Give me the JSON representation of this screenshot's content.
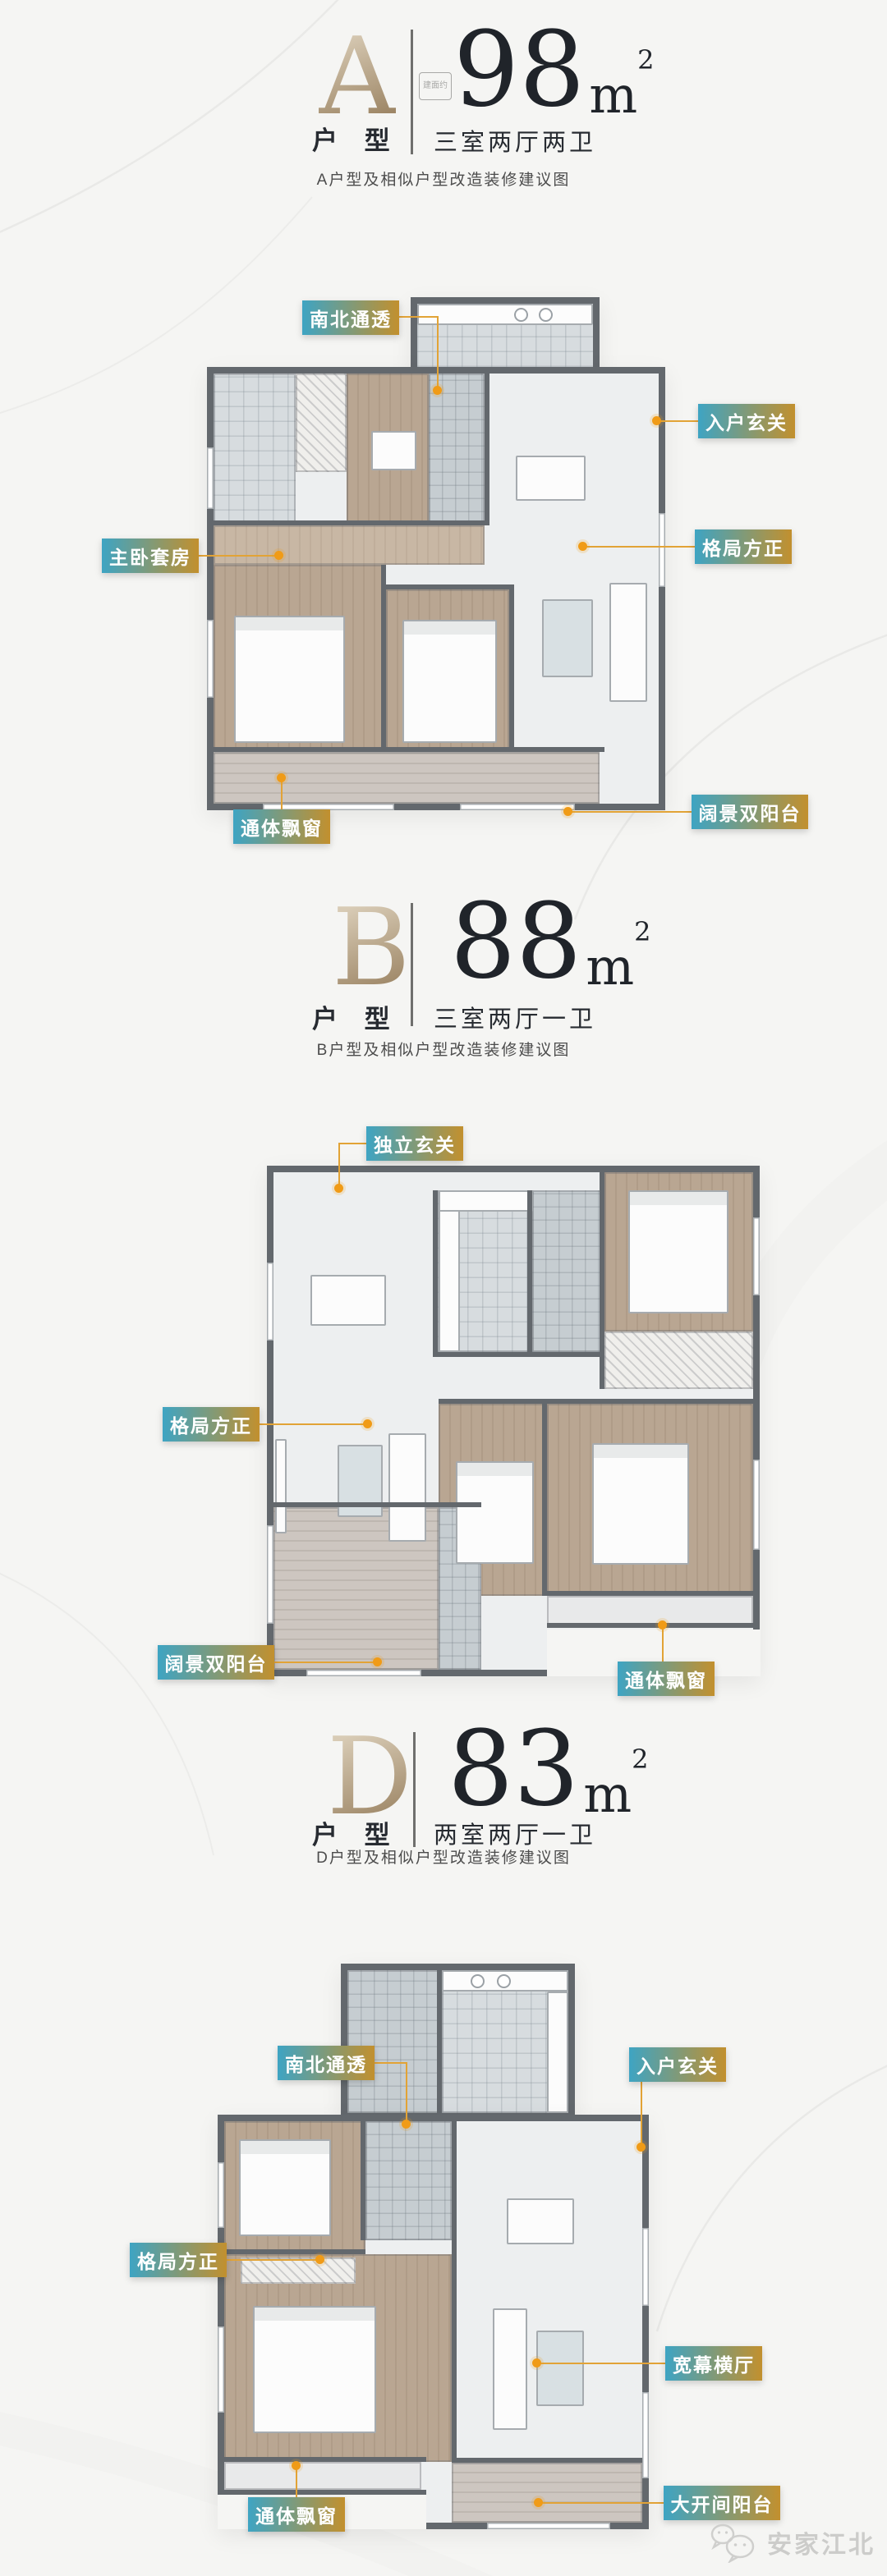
{
  "colors": {
    "page_background": "#F5F5F3",
    "tag_gradient_start": "#3EA4C3",
    "tag_gradient_end": "#C2902E",
    "leader_line": "#E2A336",
    "leader_dot": "#F09B17",
    "letter_gold": "#B59C7B",
    "heading_text": "#272B31",
    "wall": "#63686D",
    "wood_floor": "#B9A692",
    "marble_floor": "#EDEFF0",
    "tile_floor": "#D7DCDF",
    "balcony_floor": "#CDC6C0",
    "watermark_gray": "#CCCCCA"
  },
  "sections": [
    {
      "letter": "A",
      "letter_caption": "户 型",
      "area_badge": "建面约",
      "area_number": "98",
      "area_unit": "m",
      "area_exponent": "2",
      "spec": "三室两厅两卫",
      "subtitle": "A户型及相似户型改造装修建议图",
      "labels": [
        {
          "text": "南北通透"
        },
        {
          "text": "入户玄关"
        },
        {
          "text": "主卧套房"
        },
        {
          "text": "格局方正"
        },
        {
          "text": "阔景双阳台"
        },
        {
          "text": "通体飘窗"
        }
      ]
    },
    {
      "letter": "B",
      "letter_caption": "户 型",
      "area_number": "88",
      "area_unit": "m",
      "area_exponent": "2",
      "spec": "三室两厅一卫",
      "subtitle": "B户型及相似户型改造装修建议图",
      "labels": [
        {
          "text": "独立玄关"
        },
        {
          "text": "格局方正"
        },
        {
          "text": "阔景双阳台"
        },
        {
          "text": "通体飘窗"
        }
      ]
    },
    {
      "letter": "D",
      "letter_caption": "户 型",
      "area_number": "83",
      "area_unit": "m",
      "area_exponent": "2",
      "spec": "两室两厅一卫",
      "subtitle": "D户型及相似户型改造装修建议图",
      "labels": [
        {
          "text": "南北通透"
        },
        {
          "text": "入户玄关"
        },
        {
          "text": "格局方正"
        },
        {
          "text": "宽幕横厅"
        },
        {
          "text": "通体飘窗"
        },
        {
          "text": "大开间阳台"
        }
      ]
    }
  ],
  "watermark": {
    "text": "安家江北",
    "icon": "chat-bubbles-icon"
  }
}
